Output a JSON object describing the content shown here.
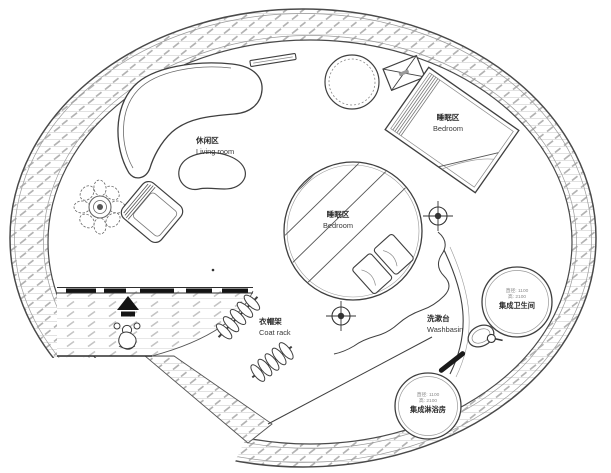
{
  "drawing": {
    "title": "circular-house-floor-plan",
    "rooms": {
      "living": {
        "zh": "休闲区",
        "en": "Living room"
      },
      "bedroom_upper": {
        "zh": "睡眠区",
        "en": "Bedroom"
      },
      "bedroom_center": {
        "zh": "睡眠区",
        "en": "Bedroom"
      },
      "coat_rack": {
        "zh": "衣帽架",
        "en": "Coat rack"
      },
      "washbasin": {
        "zh": "洗漱台",
        "en": "Washbasin"
      }
    },
    "pods": {
      "bathroom": {
        "name": "集成卫生间",
        "spec_diameter": "直径: 1100",
        "spec_height": "高: 2100"
      },
      "shower": {
        "name": "集成淋浴房",
        "spec_diameter": "直径: 1100",
        "spec_height": "高: 2100"
      }
    },
    "colors": {
      "line": "#3f3f3f",
      "hatch_light": "#d9d9d9",
      "hatch_dark": "#b2b2b2",
      "background": "#ffffff",
      "solid_fill": "#141414"
    }
  }
}
